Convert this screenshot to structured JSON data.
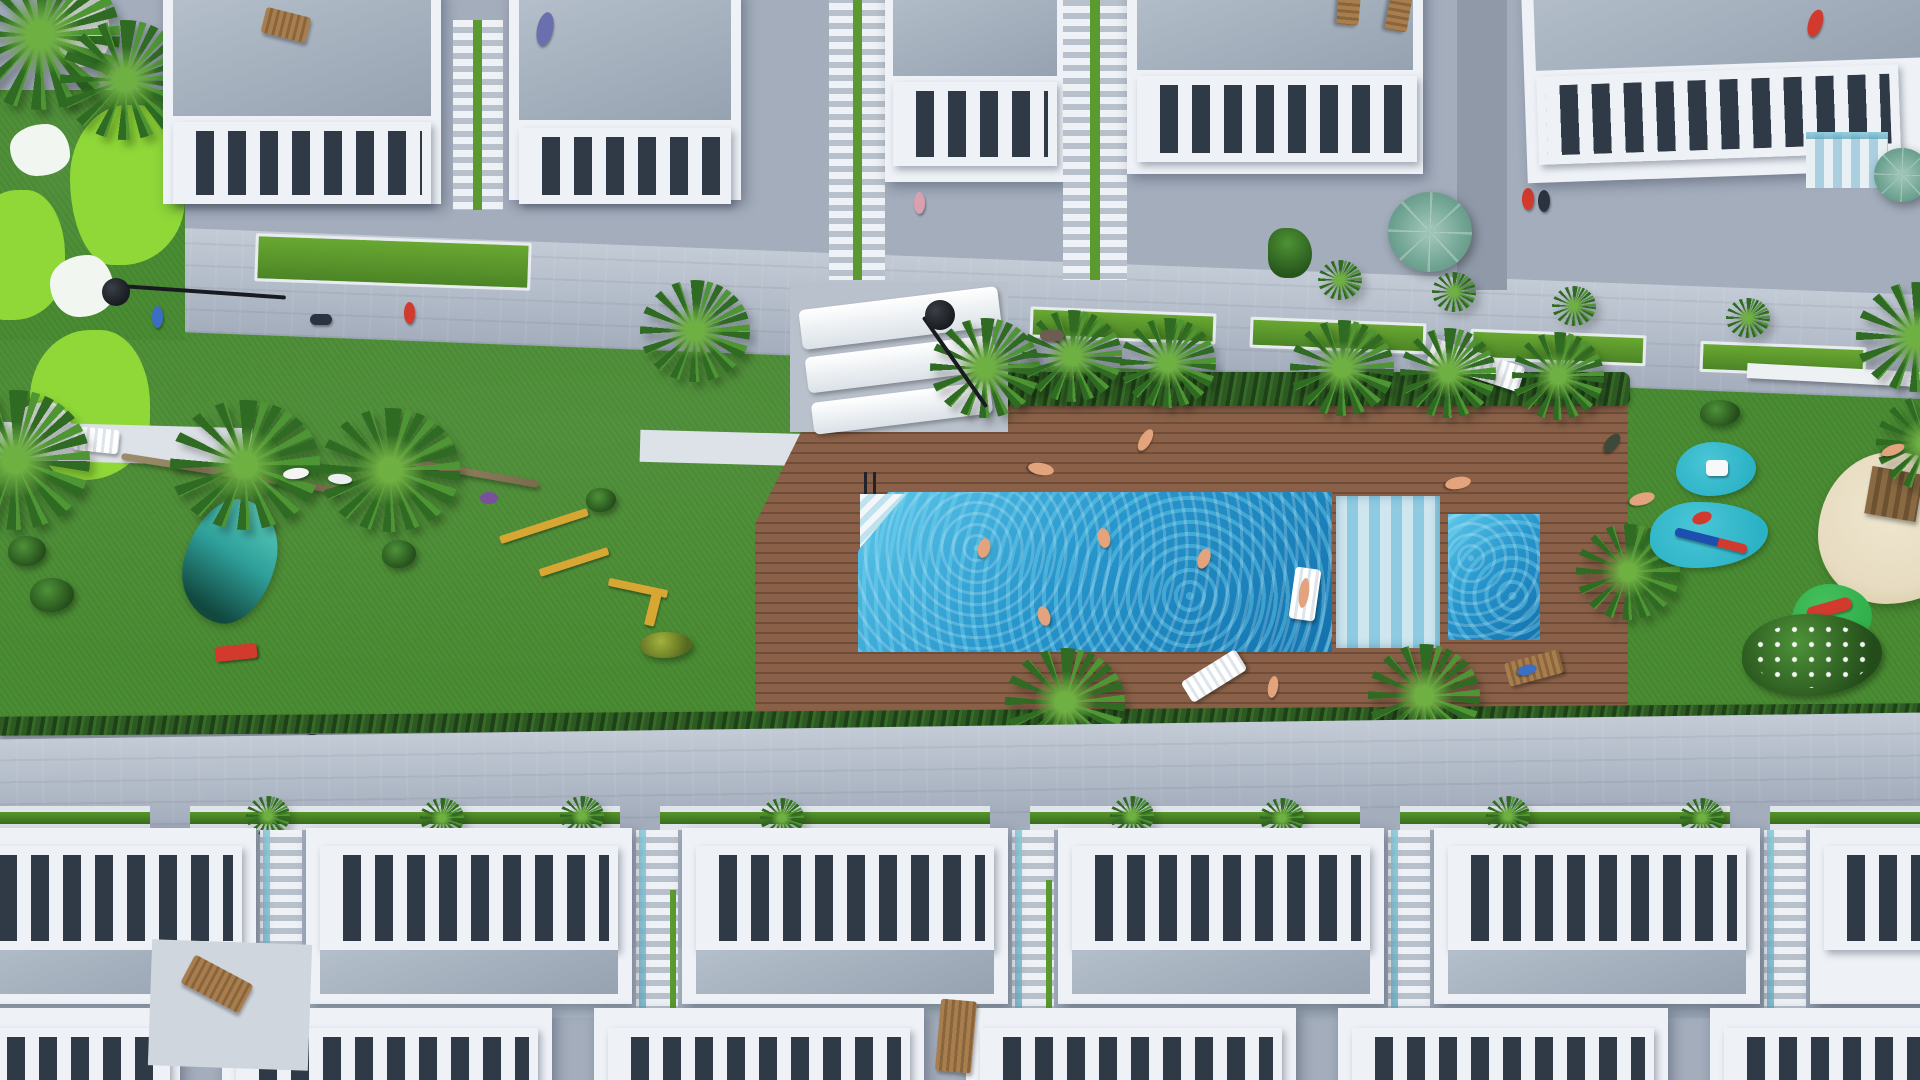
{
  "scene": {
    "title": "Aerial top-down 3D render of a white residential complex with communal pool garden",
    "view": "top-down aerial render",
    "areas": {
      "top": "row of white townhouses with grey roof terraces and balustrade railings",
      "middle": "communal garden strip with pool deck, lawns and playground",
      "bottom": "two rows of white townhouses with roof terraces and connecting stairs"
    },
    "pool_area": {
      "main_pool": "large rectangular pool on wooden deck",
      "kids_pool": "small square pool right of wide deck steps",
      "swimmers": 4,
      "float_mattress": 1,
      "pool_ladder": 1,
      "corner_steps": 1,
      "sun_loungers": 5,
      "sunbathers": 4
    },
    "playground": {
      "rubber_pads": 2,
      "spring_rider_car": 1,
      "seesaw": 1,
      "sand_pit_with_climber": 1,
      "slide_pad": 1,
      "flowering_bush": 1
    },
    "garden": {
      "putting_green": "light green patches with white sand bunkers, top-left",
      "pond": 1,
      "outdoor_gym_bars": 4,
      "white_dog_statues": 2,
      "street_lamps": 5,
      "umbrellas": 2,
      "palm_trees": 18,
      "hedge_rows": 3
    },
    "people_walking": 9
  },
  "palette": {
    "grass": "#4a8c33",
    "grass_dark": "#3c7429",
    "golf_light": "#8fd838",
    "bunker": "#f2f6f1",
    "walkway": "#a3adbc",
    "walkway_light": "#c3cbd6",
    "deck": "#8a6148",
    "deck_dark": "#6f4d39",
    "pool": "#2796cc",
    "pool_light": "#5ec8ea",
    "pool_deep": "#1372ae",
    "building": "#eef2f7",
    "roof": "#b4bfcb",
    "roof_dark": "#96a2b0",
    "void": "#2f3a46",
    "hedge": "#2d5a22",
    "palm": "#2f6b22",
    "palm_light": "#6fb043",
    "sand": "#e7dcc1",
    "rubber": "#2cb2c6",
    "playground_green": "#2fae4a",
    "accent_red": "#d23a2e",
    "accent_yellow": "#d8a733",
    "umbrella": "#6fa392",
    "lamp": "#181b1f",
    "skin": "#e3a37c",
    "water_teal": "#2f9f9a",
    "wood": "#a87e4e"
  }
}
